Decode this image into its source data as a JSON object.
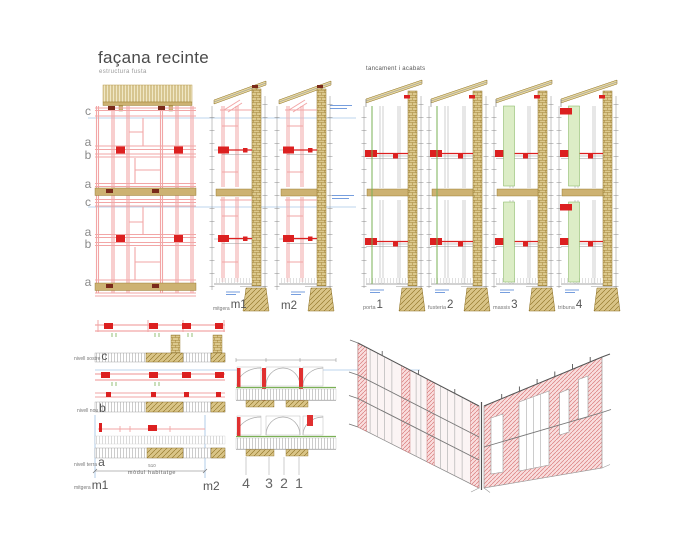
{
  "title": "façana recinte",
  "subtitle": "estructura fusta",
  "facade": {
    "levels": [
      "c",
      "a",
      "b",
      "a",
      "c",
      "a",
      "b",
      "a"
    ]
  },
  "mid_sections": {
    "m1_word": "mitgera",
    "m1_num": "m1",
    "m2_num": "m2"
  },
  "right_group": {
    "title": "tancament i acabats",
    "sections": [
      {
        "name": "porta",
        "num": "1"
      },
      {
        "name": "fusteria",
        "num": "2"
      },
      {
        "name": "massis",
        "num": "3"
      },
      {
        "name": "tribuna",
        "num": "4"
      }
    ]
  },
  "left_details": {
    "rows": [
      {
        "name": "nivell sostre",
        "letter": "c"
      },
      {
        "name": "nivell nou",
        "letter": "b"
      },
      {
        "name": "nivell terra",
        "letter": "a"
      }
    ],
    "m1_word": "mitgera",
    "m1_num": "m1",
    "m2_num": "m2",
    "dim": "510",
    "dim_label": "mòdul habitatge"
  },
  "mid_details": {
    "callouts": [
      "4",
      "3",
      "2",
      "1"
    ]
  },
  "colors": {
    "pink": "#f2a6a6",
    "red": "#dc2020",
    "tan": "#cdb272",
    "green": "#7ab055",
    "blue": "#4a7fd4",
    "lightblue": "#a9c7e8"
  }
}
